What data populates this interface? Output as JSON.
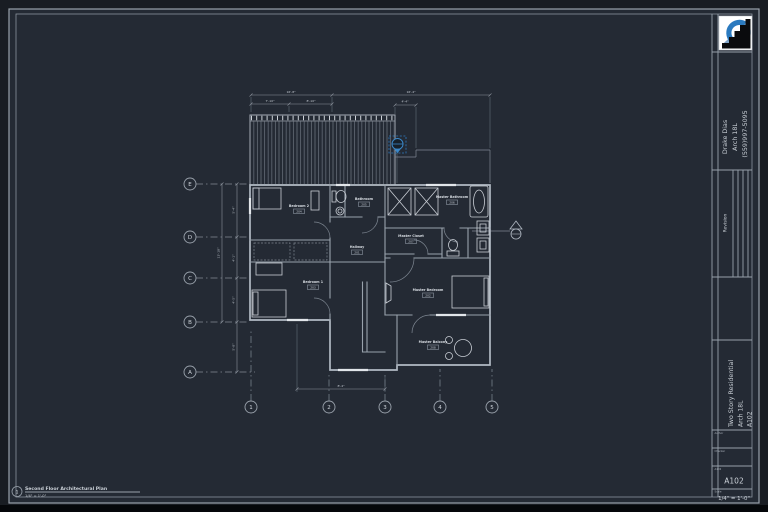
{
  "colors": {
    "sheet_bg": "#242a34",
    "line": "#98a0aa",
    "accent_blue": "#3a87c8",
    "white": "#ffffff"
  },
  "title_block": {
    "contact": {
      "name": "Drake Dias",
      "course": "Arch 18L",
      "phone": "(559)997-5095"
    },
    "revision_label": "Revision",
    "project": {
      "title": "Two Story Residential",
      "course": "Arch 18L",
      "sheet": "A102"
    },
    "fields": {
      "author_label": "Author",
      "checker_label": "Checker",
      "sheet_label": "A102",
      "sheet_value": "A102",
      "scale_label": "Scale",
      "scale_value": "1/4\" = 1'-0\""
    }
  },
  "view_title": {
    "number": "1",
    "title": "Second Floor Architectural Plan",
    "scale": "1/4\" = 1'-0\""
  },
  "grids": {
    "rows": [
      {
        "label": "E"
      },
      {
        "label": "D"
      },
      {
        "label": "C"
      },
      {
        "label": "B"
      },
      {
        "label": "A"
      }
    ],
    "cols": [
      {
        "label": "1"
      },
      {
        "label": "2"
      },
      {
        "label": "3"
      },
      {
        "label": "4"
      },
      {
        "label": "5"
      }
    ]
  },
  "rooms": [
    {
      "name": "Bedroom 2",
      "number": "204"
    },
    {
      "name": "Bathroom",
      "number": "205"
    },
    {
      "name": "Master Bathroom",
      "number": "206"
    },
    {
      "name": "Master Closet",
      "number": "207"
    },
    {
      "name": "Hallway",
      "number": "201"
    },
    {
      "name": "Bedroom 1",
      "number": "203"
    },
    {
      "name": "Master Bedroom",
      "number": "202"
    },
    {
      "name": "Master Balcony",
      "number": "208"
    }
  ],
  "dimensions": {
    "top1_left": "16'-8\"",
    "top1_right": "16'-4\"",
    "top2_left": "7'-10\"",
    "top2_right": "8'-10\"",
    "top_small": "4'-4\"",
    "bottom": "8'-4\"",
    "left_total": "13'-10\"",
    "left_segments": [
      "5'-4\"",
      "4'-1\"",
      "4'-5\"",
      "5'-0\""
    ]
  }
}
